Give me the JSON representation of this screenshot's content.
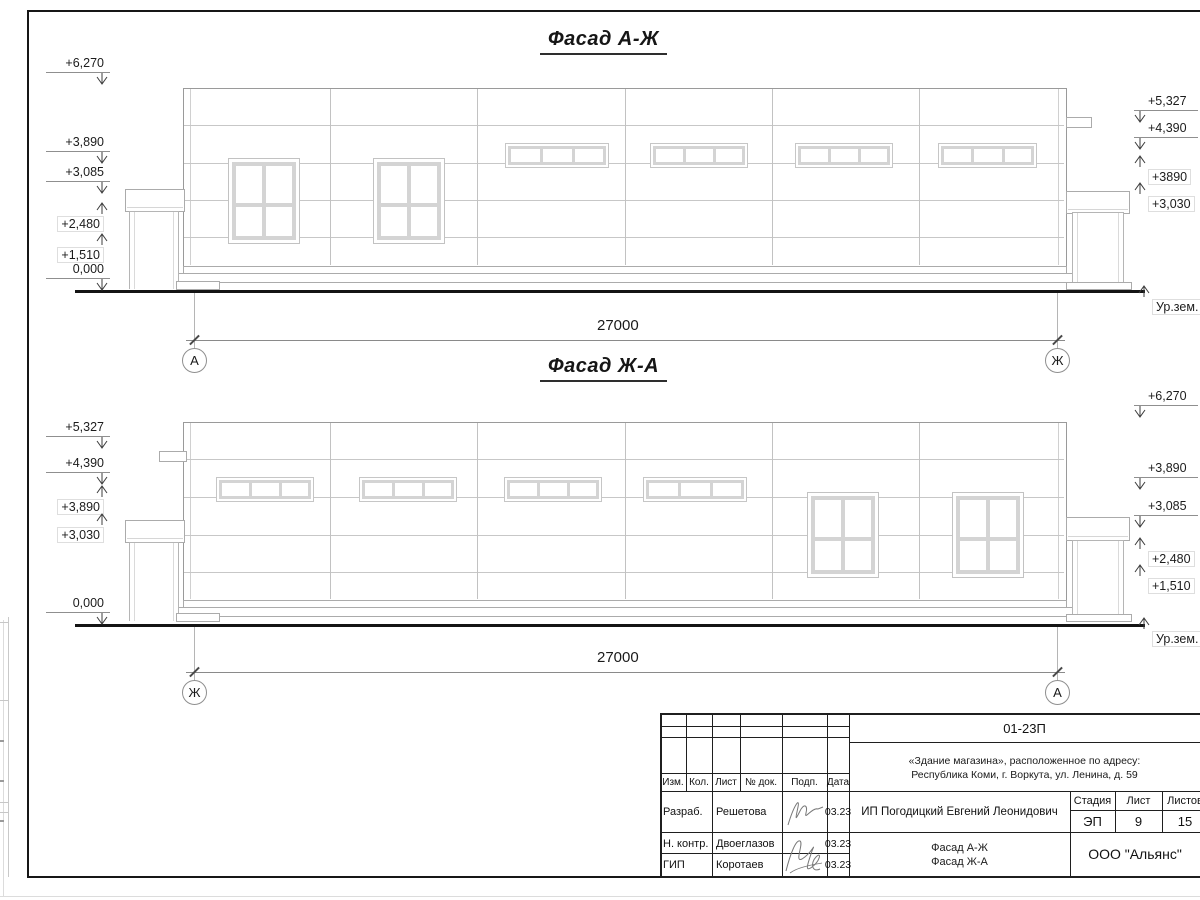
{
  "drawing": {
    "facade_top": {
      "title": "Фасад А-Ж",
      "dimension": "27000",
      "axis_left": "А",
      "axis_right": "Ж",
      "marks_left": [
        "+6,270",
        "+3,890",
        "+3,085",
        "+2,480",
        "+1,510",
        "0,000"
      ],
      "marks_right": [
        "+5,327",
        "+4,390",
        "+3890",
        "+3,030"
      ],
      "ground_label": "Ур.зем."
    },
    "facade_bottom": {
      "title": "Фасад Ж-А",
      "dimension": "27000",
      "axis_left": "Ж",
      "axis_right": "А",
      "marks_left": [
        "+5,327",
        "+4,390",
        "+3,890",
        "+3,030",
        "0,000"
      ],
      "marks_right": [
        "+6,270",
        "+3,890",
        "+3,085",
        "+2,480",
        "+1,510"
      ],
      "ground_label": "Ур.зем."
    }
  },
  "title_block": {
    "doc_number": "01-23П",
    "object_line1": "«Здание магазина», расположенное по адресу:",
    "object_line2": "Республика Коми, г. Воркута, ул. Ленина, д. 59",
    "columns": {
      "izm": "Изм.",
      "kol": "Кол.",
      "list": "Лист",
      "doc": "№ док.",
      "podp": "Подп.",
      "data": "Дата"
    },
    "signers": [
      {
        "role": "Разраб.",
        "name": "Решетова",
        "date": "03.23"
      },
      {
        "role": "Н. контр.",
        "name": "Двоеглазов",
        "date": "03.23"
      },
      {
        "role": "ГИП",
        "name": "Коротаев",
        "date": "03.23"
      }
    ],
    "client": "ИП Погодицкий Евгений Леонидович",
    "stage_label": "Стадия",
    "stage_value": "ЭП",
    "sheet_label": "Лист",
    "sheet_value": "9",
    "sheets_label": "Листов",
    "sheets_value": "15",
    "drawing_title_line1": "Фасад А-Ж",
    "drawing_title_line2": "Фасад Ж-А",
    "company": "ООО \"Альянс\""
  }
}
